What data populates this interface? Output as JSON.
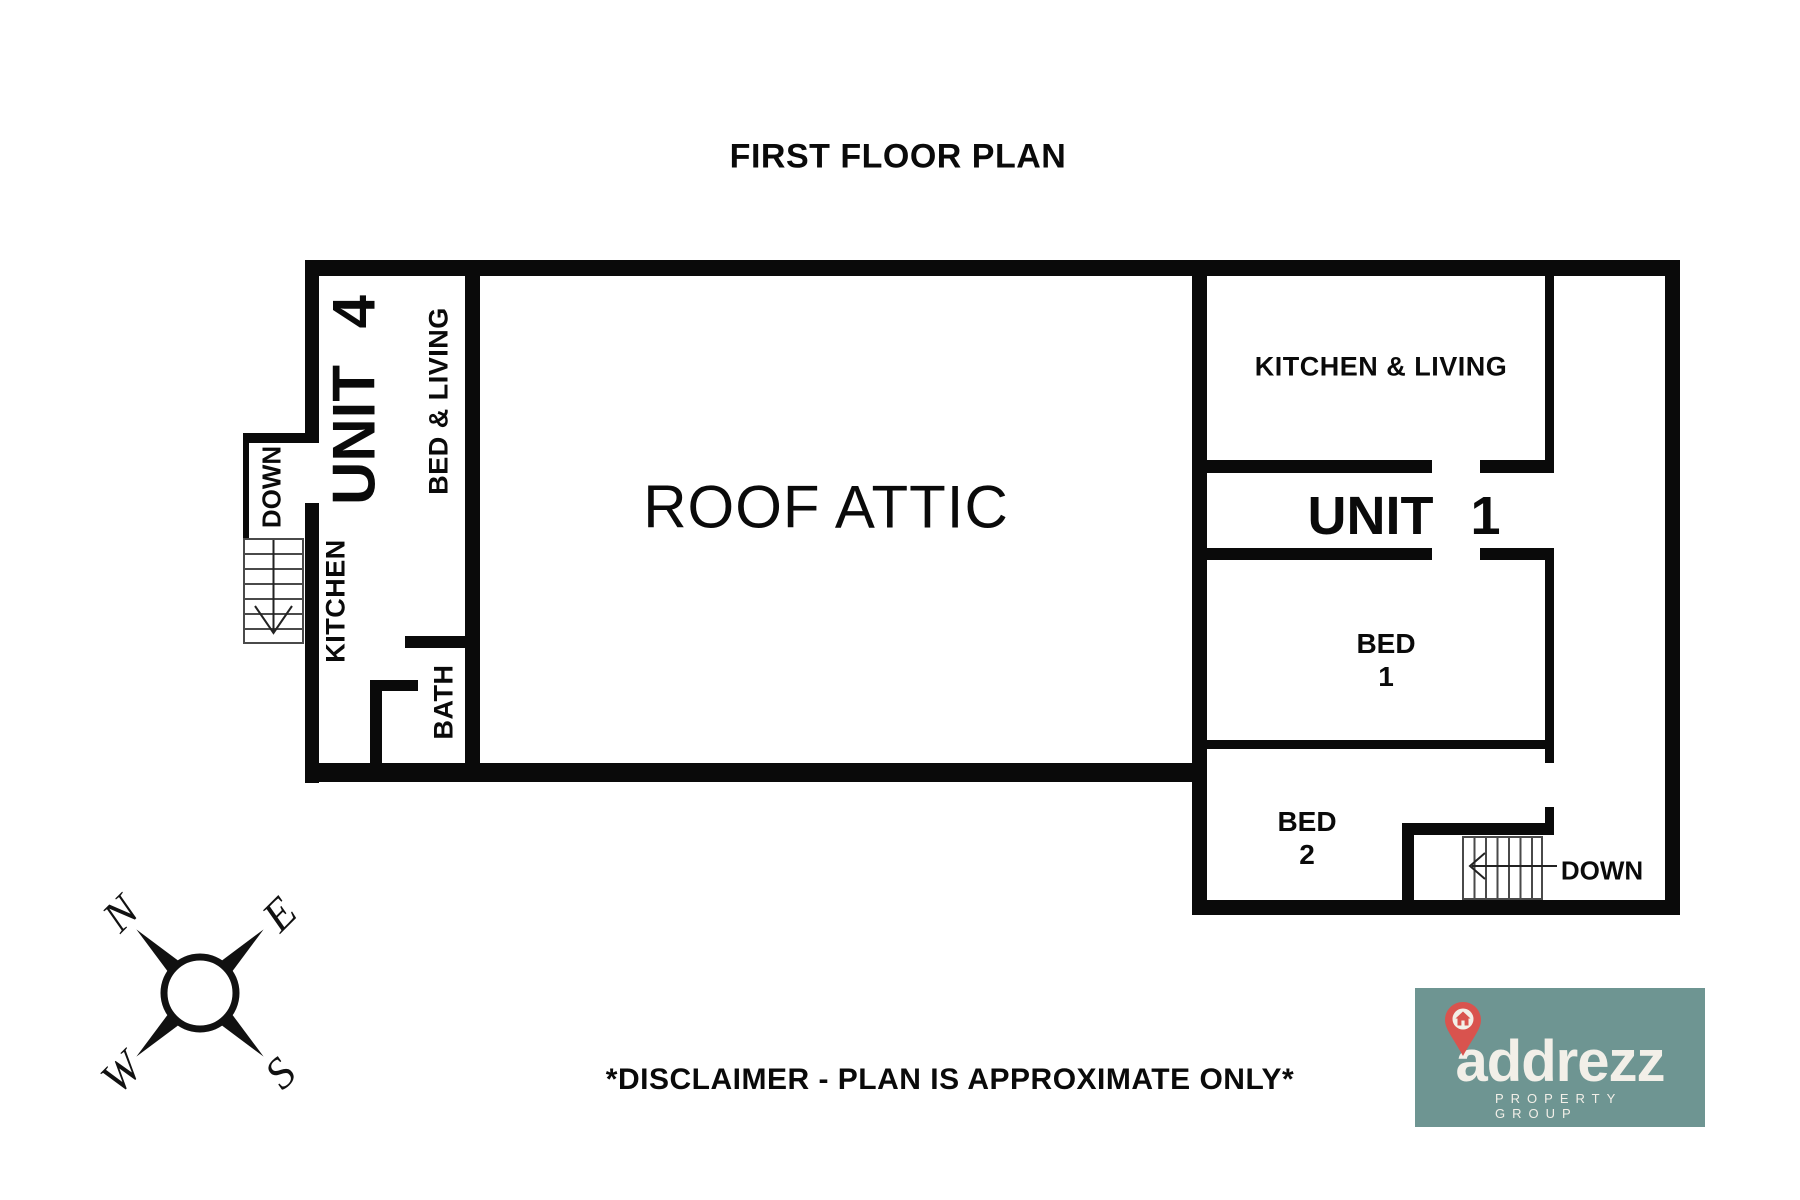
{
  "title": "FIRST FLOOR PLAN",
  "plan": {
    "wall_color": "#0a0a0a",
    "unit4": {
      "name": "UNIT 4",
      "stairs_label": "DOWN",
      "rooms": {
        "bed_living": "BED & LIVING",
        "kitchen": "KITCHEN",
        "bath": "BATH"
      }
    },
    "attic": {
      "label": "ROOF ATTIC"
    },
    "unit1": {
      "name": "UNIT 1",
      "stairs_label": "DOWN",
      "rooms": {
        "kitchen_living": "KITCHEN & LIVING",
        "bed1_line1": "BED",
        "bed1_line2": "1",
        "bed2_line1": "BED",
        "bed2_line2": "2"
      }
    }
  },
  "compass": {
    "n": "N",
    "e": "E",
    "s": "S",
    "w": "W"
  },
  "disclaimer": "*DISCLAIMER - PLAN IS APPROXIMATE ONLY*",
  "logo": {
    "brand": "addrezz",
    "tagline": "PROPERTY GROUP",
    "colors": {
      "background": "#6E9592",
      "text": "#F2EFE8",
      "pin": "#D9534E"
    }
  }
}
